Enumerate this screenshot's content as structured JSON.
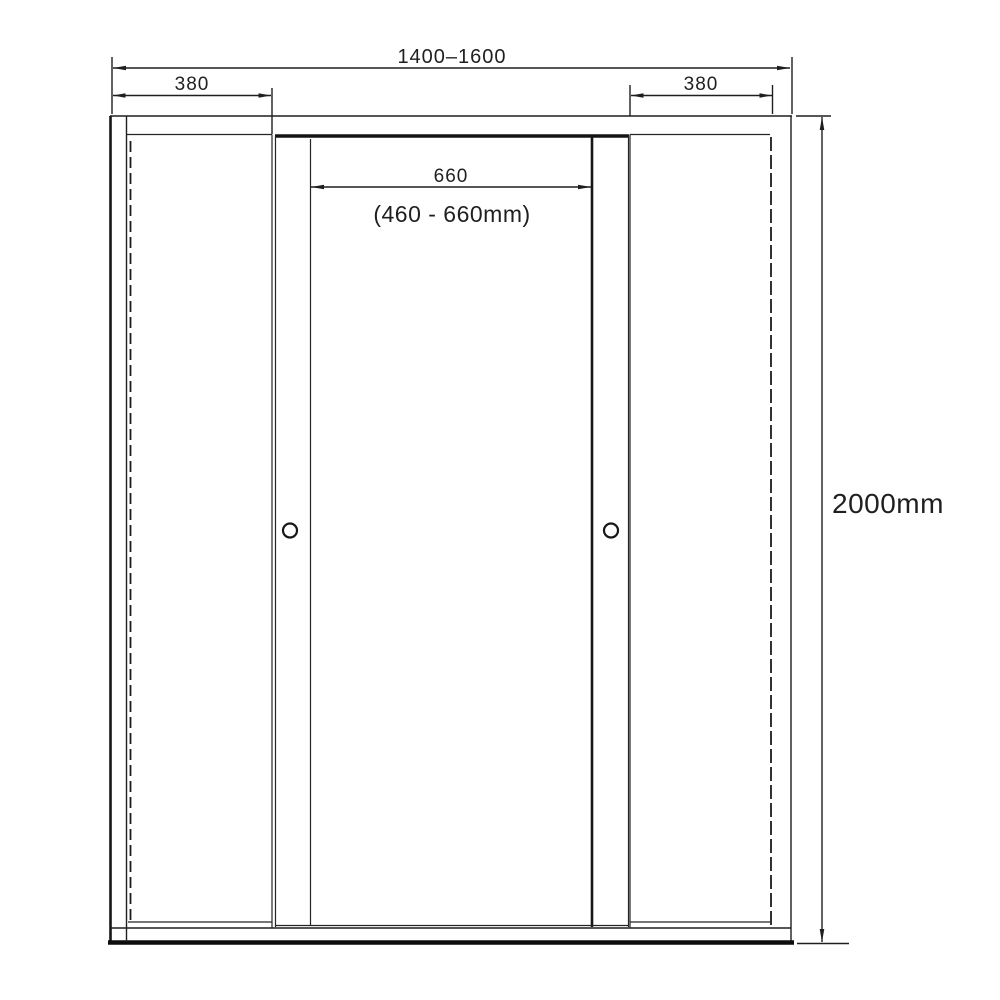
{
  "drawing": {
    "kind": "sliding-door-dimension-diagram",
    "colors": {
      "line": "#1f1f1f",
      "background": "#ffffff"
    }
  },
  "dimensions": {
    "total_width": {
      "label": "1400–1600"
    },
    "left_panel_width": {
      "label": "380"
    },
    "right_panel_width": {
      "label": "380"
    },
    "door_opening": {
      "label": "660",
      "range_label": "(460 - 660mm)"
    },
    "height": {
      "label": "2000mm"
    }
  }
}
